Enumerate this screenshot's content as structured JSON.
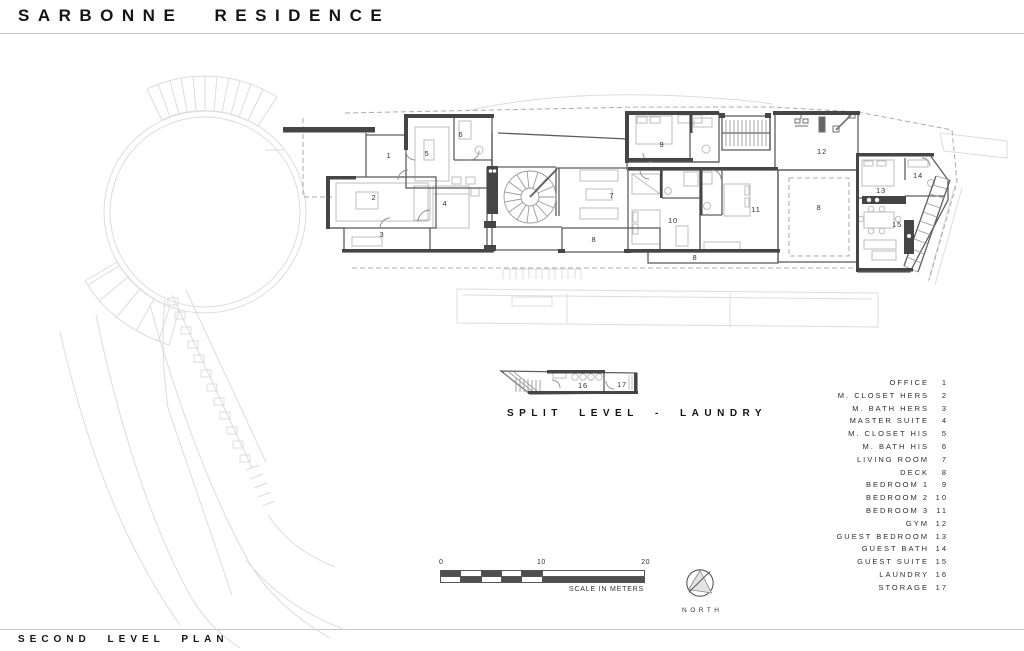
{
  "title": "SARBONNE RESIDENCE",
  "plan_label": "SECOND LEVEL PLAN",
  "split_level_label": "SPLIT LEVEL - LAUNDRY",
  "north_label": "NORTH",
  "scale_bar": {
    "ticks": [
      "0",
      "10",
      "20"
    ],
    "caption": "SCALE IN METERS"
  },
  "legend": {
    "items": [
      {
        "label": "OFFICE",
        "number": "1"
      },
      {
        "label": "M. CLOSET HERS",
        "number": "2"
      },
      {
        "label": "M. BATH HERS",
        "number": "3"
      },
      {
        "label": "MASTER SUITE",
        "number": "4"
      },
      {
        "label": "M. CLOSET HIS",
        "number": "5"
      },
      {
        "label": "M. BATH HIS",
        "number": "6"
      },
      {
        "label": "LIVING ROOM",
        "number": "7"
      },
      {
        "label": "DECK",
        "number": "8"
      },
      {
        "label": "BEDROOM 1",
        "number": "9"
      },
      {
        "label": "BEDROOM 2",
        "number": "10"
      },
      {
        "label": "BEDROOM 3",
        "number": "11"
      },
      {
        "label": "GYM",
        "number": "12"
      },
      {
        "label": "GUEST BEDROOM",
        "number": "13"
      },
      {
        "label": "GUEST BATH",
        "number": "14"
      },
      {
        "label": "GUEST SUITE",
        "number": "15"
      },
      {
        "label": "LAUNDRY",
        "number": "16"
      },
      {
        "label": "STORAGE",
        "number": "17"
      }
    ]
  },
  "room_labels": [
    {
      "text": "1",
      "x": 389,
      "y": 158
    },
    {
      "text": "2",
      "x": 374,
      "y": 200
    },
    {
      "text": "3",
      "x": 382,
      "y": 237
    },
    {
      "text": "4",
      "x": 445,
      "y": 206
    },
    {
      "text": "5",
      "x": 427,
      "y": 156
    },
    {
      "text": "6",
      "x": 461,
      "y": 137
    },
    {
      "text": "7",
      "x": 612,
      "y": 198
    },
    {
      "text": "8",
      "x": 594,
      "y": 242
    },
    {
      "text": "8",
      "x": 695,
      "y": 260
    },
    {
      "text": "8",
      "x": 819,
      "y": 210
    },
    {
      "text": "9",
      "x": 662,
      "y": 147
    },
    {
      "text": "10",
      "x": 673,
      "y": 223
    },
    {
      "text": "11",
      "x": 756,
      "y": 212
    },
    {
      "text": "12",
      "x": 822,
      "y": 154
    },
    {
      "text": "13",
      "x": 881,
      "y": 193
    },
    {
      "text": "14",
      "x": 918,
      "y": 178
    },
    {
      "text": "15",
      "x": 897,
      "y": 227
    },
    {
      "text": "16",
      "x": 583,
      "y": 388
    },
    {
      "text": "17",
      "x": 622,
      "y": 387
    }
  ],
  "colors": {
    "wall_dark": "#454545",
    "wall_medium": "#5e5e5e",
    "site_light": "#dcdcdc",
    "dashed": "#ababab",
    "furniture": "#bdbdbd",
    "text": "#1d1d1d"
  }
}
